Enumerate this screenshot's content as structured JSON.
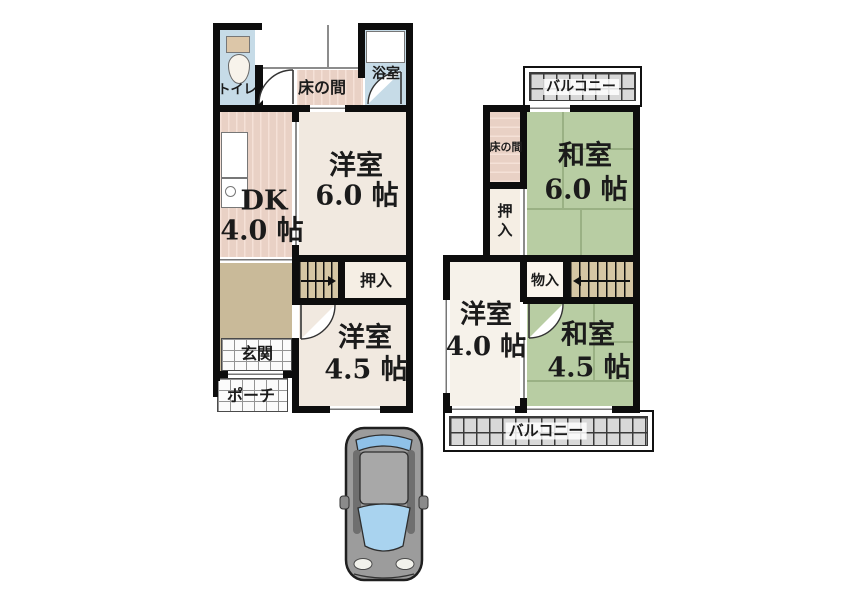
{
  "floor1": {
    "toilet": "トイレ",
    "tokonoma": "床の間",
    "bath": "浴室",
    "dk": {
      "name": "DK",
      "size": "4.0 帖"
    },
    "western6": {
      "name": "洋室",
      "size": "6.0 帖"
    },
    "closet": "押入",
    "entrance": "玄関",
    "porch": "ポーチ",
    "western45": {
      "name": "洋室",
      "size": "4.5 帖"
    }
  },
  "floor2": {
    "balcony_top": "バルコニー",
    "tokonoma": "床の間",
    "japanese6": {
      "name": "和室",
      "size": "6.0 帖"
    },
    "closet": "押入",
    "storage": "物入",
    "western4": {
      "name": "洋室",
      "size": "4.0 帖"
    },
    "japanese45": {
      "name": "和室",
      "size": "4.5 帖"
    },
    "balcony_bottom": "バルコニー"
  },
  "objects": {
    "car": "car-top-view-icon",
    "stair_arrow_1f_direction": "right",
    "stair_arrow_2f_direction": "left"
  },
  "colors": {
    "wall": "#0d0d0d",
    "tatami_green": "#b8cda3",
    "room_cream": "#f1e9e0",
    "wood_pink": "#e9d1c5",
    "water_blue": "#c6dbe7",
    "hall_tan": "#c9ba99",
    "stairs_tan": "#d5c6a4",
    "balcony_gray": "#d8d8d8"
  }
}
